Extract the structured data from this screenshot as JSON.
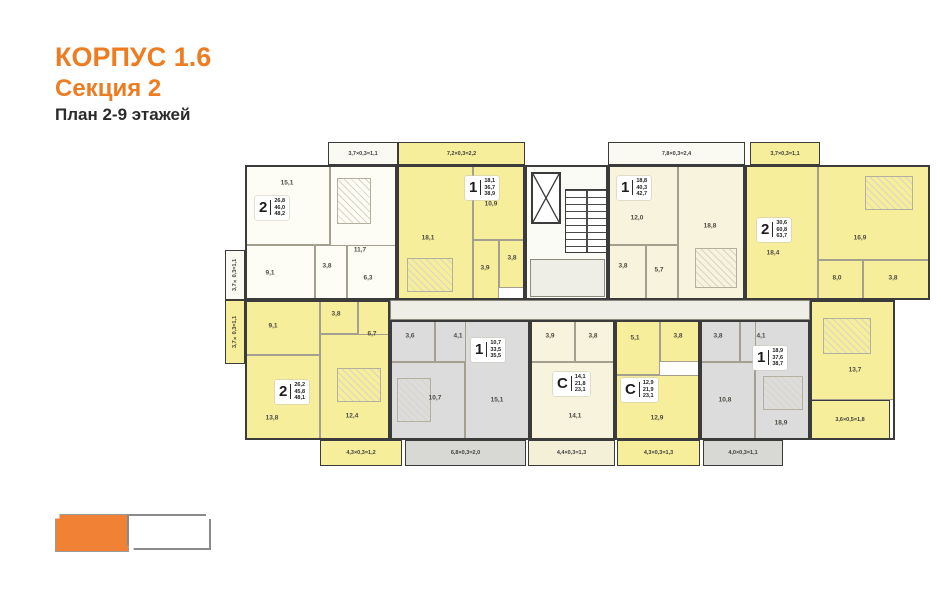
{
  "title": {
    "building": "КОРПУС 1.6",
    "section": "Секция 2",
    "plan": "План 2-9 этажей"
  },
  "colors": {
    "accent_orange": "#ED7D23",
    "apartment_yellow": "#F7EE9B",
    "apartment_cream": "#F7F3DC",
    "apartment_white": "#FDFDF6",
    "apartment_gray": "#DCDCDC",
    "wall_dark": "#3B3B3B",
    "legend_orange": "#F08135"
  },
  "apartments": [
    {
      "type": "2",
      "living": "26,8",
      "area": "46,0",
      "total": "48,2",
      "rooms": [
        "15,1",
        "11,7",
        "9,1",
        "3,8",
        "6,3"
      ]
    },
    {
      "type": "1",
      "living": "18,1",
      "area": "36,7",
      "total": "38,9",
      "rooms": [
        "18,1",
        "10,9",
        "3,9",
        "3,8"
      ]
    },
    {
      "type": "1",
      "living": "18,8",
      "area": "40,3",
      "total": "42,7",
      "rooms": [
        "12,0",
        "18,8",
        "3,8",
        "5,7"
      ]
    },
    {
      "type": "2",
      "living": "30,6",
      "area": "60,8",
      "total": "63,7",
      "rooms": [
        "18,4",
        "16,9",
        "8,0",
        "3,8",
        "13,7"
      ]
    },
    {
      "type": "2",
      "living": "26,2",
      "area": "45,8",
      "total": "48,1",
      "rooms": [
        "9,1",
        "3,8",
        "6,7",
        "12,4",
        "13,8"
      ]
    },
    {
      "type": "1",
      "living": "10,7",
      "area": "33,5",
      "total": "35,5",
      "rooms": [
        "3,6",
        "4,1",
        "10,7",
        "15,1"
      ]
    },
    {
      "type": "С",
      "living": "14,1",
      "area": "21,8",
      "total": "23,1",
      "rooms": [
        "3,9",
        "3,8",
        "14,1"
      ]
    },
    {
      "type": "С",
      "living": "12,9",
      "area": "21,9",
      "total": "23,1",
      "rooms": [
        "5,1",
        "3,8",
        "12,9"
      ]
    },
    {
      "type": "1",
      "living": "18,9",
      "area": "37,6",
      "total": "38,7",
      "rooms": [
        "3,8",
        "4,1",
        "10,8",
        "18,9"
      ]
    }
  ],
  "balconies": {
    "top": [
      "3,7×0,3=1,1",
      "7,2×0,3=2,2",
      "7,8×0,3=2,4",
      "3,7×0,3=1,1"
    ],
    "left": [
      "3,7×0,3=1,1",
      "3,7×0,3=1,1"
    ],
    "bottom": [
      "4,3×0,3=1,2",
      "6,8×0,3=2,0",
      "4,4×0,3=1,3",
      "4,3×0,3=1,3",
      "4,0×0,3=1,1"
    ],
    "right": [
      "3,6×0,5=1,8"
    ]
  }
}
